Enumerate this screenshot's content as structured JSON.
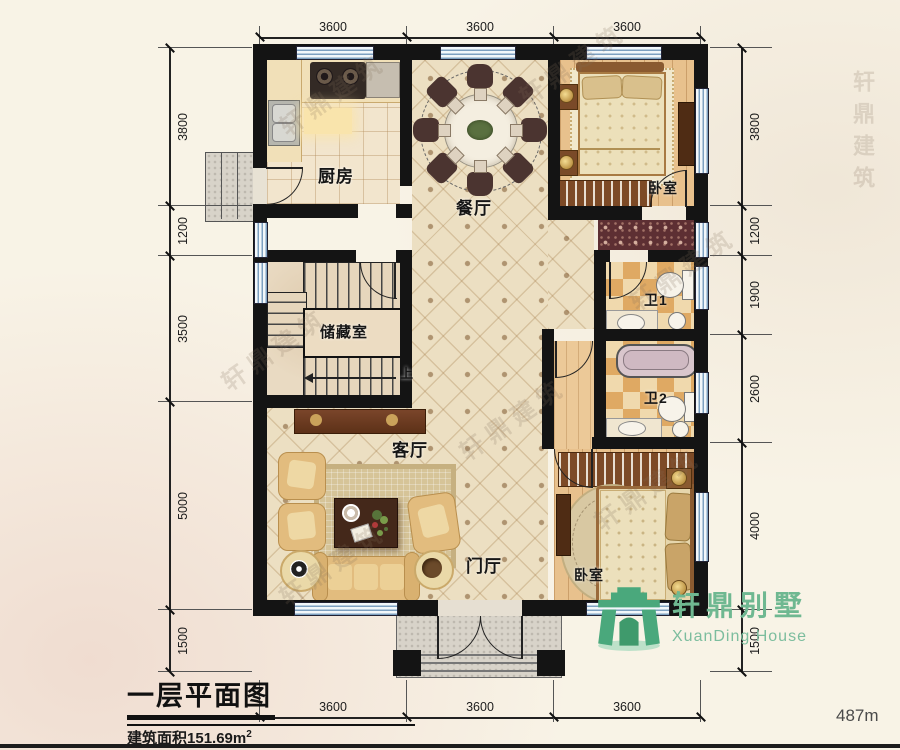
{
  "dims": {
    "top": [
      "3600",
      "3600",
      "3600"
    ],
    "bottom": [
      "3600",
      "3600",
      "3600"
    ],
    "left": [
      "3800",
      "1200",
      "3500",
      "5000",
      "1500"
    ],
    "right": [
      "3800",
      "1200",
      "1900",
      "2600",
      "4000",
      "1500"
    ]
  },
  "rooms": {
    "kitchen": "厨房",
    "dining": "餐厅",
    "bedroom1": "卧室",
    "bath1": "卫1",
    "bath2": "卫2",
    "storage": "储藏室",
    "living": "客厅",
    "foyer": "门厅",
    "bedroom2": "卧室",
    "stair_up": "上"
  },
  "title_block": {
    "title": "一层平面图",
    "area_prefix": "建筑面积",
    "area_value": "151.69",
    "area_unit": "m",
    "area_sup": "2"
  },
  "logo": {
    "cn": "轩鼎别墅",
    "en": "XuanDing House"
  },
  "footer": {
    "note": "487m"
  },
  "watermark": {
    "text": "轩鼎建筑"
  },
  "colors": {
    "logo_green": "#4aa87c",
    "wall_black": "#141414",
    "window_blue": "#7da0c0"
  }
}
